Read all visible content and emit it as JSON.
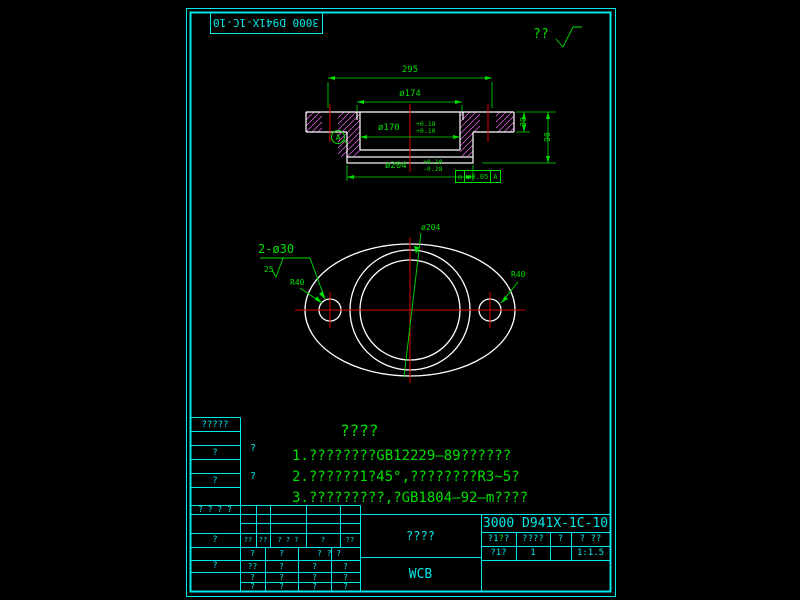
{
  "top": {
    "rotated_label": "3000 D941X-1C-10",
    "finish_text": "??"
  },
  "section_view": {
    "dim_width": "295",
    "dim_dia174": "ø174",
    "dim_dia170": "ø170",
    "dia170_tol_top": "+0.18",
    "dia170_tol_bot": "+0.10",
    "dim_dia204": "ø204",
    "dia204_tol_top": "+0.10",
    "dia204_tol_bot": "-0.28",
    "dim_thickness": "30",
    "dim_height": "90",
    "datum_label": "A",
    "gdt_symbol": "◎",
    "gdt_tolerance": "ø0.05",
    "gdt_datum": "A"
  },
  "plan_view": {
    "dim_holes": "2-ø30",
    "roughness_value": "25",
    "dim_dia204": "ø204",
    "dim_radius_left": "R40",
    "dim_radius_right": "R40"
  },
  "notes": {
    "title": "????",
    "line1": "1.????????GB12229—89??????",
    "line2": "2.??????1?45°,????????R3~5?",
    "line3": "3.?????????,?GB1804—92—m????"
  },
  "left_strip": {
    "row0": "?????",
    "row2": "?",
    "row4": "?"
  },
  "field_marks": {
    "mark1": "?",
    "mark2": "?"
  },
  "bottom_table": {
    "a_header": "? ? ? ?",
    "a_row2": "?",
    "a_row4": "?",
    "rev_header": [
      "??",
      "??",
      "? ? ?",
      "?",
      "??"
    ],
    "rev_sub": [
      "?",
      "?",
      "? ? ?"
    ],
    "rev_rows": [
      [
        "??",
        "?",
        "?",
        "?"
      ],
      [
        "?",
        "?",
        "?",
        "?"
      ],
      [
        "?",
        "?",
        "?",
        "?"
      ]
    ],
    "part_name": "????",
    "material": "WCB",
    "drawing_no": "3000 D941X-1C-10",
    "r1c1_pre": "?1",
    "r1c1_mark": "?",
    "r1c1_post": "?",
    "r1c2": "????",
    "r1c3": "?",
    "r1c4": "? ??",
    "r2c1": "?1?",
    "r2c2": "1",
    "r2c3": "",
    "r2c4": "1:1.5"
  }
}
